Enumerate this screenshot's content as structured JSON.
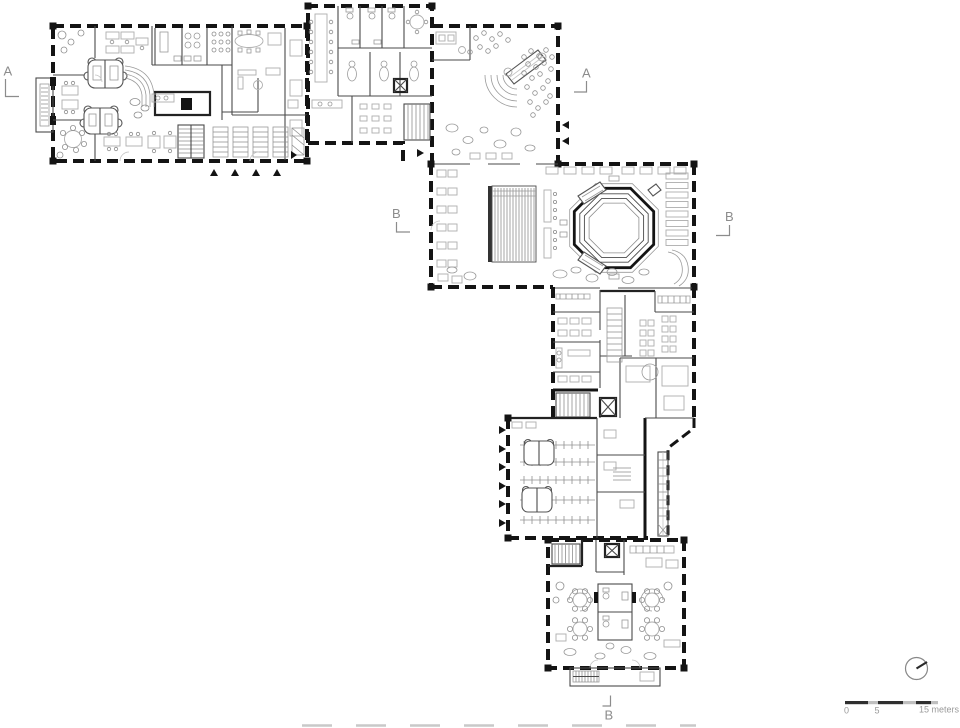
{
  "page": {
    "background": "#ffffff",
    "content": "architectural ground floor plan"
  },
  "section_markers": {
    "a_left": "A",
    "a_right": "A",
    "b_left": "B",
    "b_right": "B",
    "b_bottom": "B"
  },
  "scale_bar": {
    "tick_zero": "0",
    "tick_five": "5",
    "tick_end": "15 meters"
  },
  "north_arrow": {
    "icon": "north-compass-circle"
  },
  "colors": {
    "wall": "#141414",
    "partition": "#4a4a4a",
    "furniture": "#adadad",
    "labels": "#8c8c8c",
    "scale_dark": "#2f2f2f",
    "scale_light": "#bfbfbf"
  }
}
